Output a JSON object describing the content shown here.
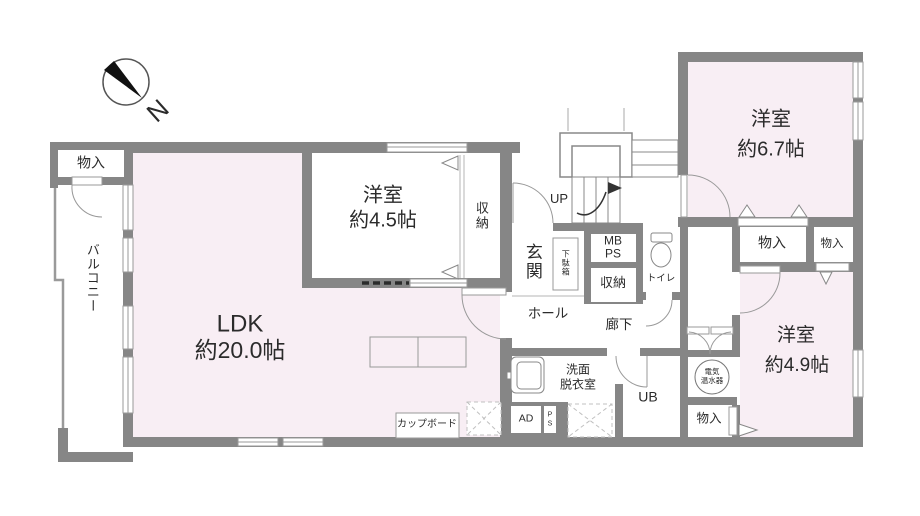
{
  "plan": {
    "compass": {
      "north_label": "N"
    },
    "rooms": {
      "ldk": {
        "name": "LDK",
        "area": "約20.0帖"
      },
      "western_4_5": {
        "name": "洋室",
        "area": "約4.5帖"
      },
      "western_6_7": {
        "name": "洋室",
        "area": "約6.7帖"
      },
      "western_4_9": {
        "name": "洋室",
        "area": "約4.9帖"
      },
      "balcony": {
        "name": "バルコニー"
      },
      "entrance": {
        "name": "玄関"
      },
      "hall": {
        "name": "ホール"
      },
      "corridor": {
        "name": "廊下"
      },
      "toilet": {
        "name": "トイレ"
      },
      "washroom": {
        "line1": "洗面",
        "line2": "脱衣室"
      },
      "unit_bath": {
        "name": "UB"
      }
    },
    "storage": {
      "closet_top_left": "物入",
      "closet_4_5": "収納",
      "shoe_box": "下駄箱",
      "closet_hall": "収納",
      "closet_right_1": "物入",
      "closet_right_2": "物入",
      "closet_bottom_right": "物入",
      "cupboard": "カップボード"
    },
    "utilities": {
      "meter_box_line1": "MB",
      "meter_box_line2": "PS",
      "air_duct": "AD",
      "pipe_space_letter1": "P",
      "pipe_space_letter2": "S",
      "water_heater_line1": "電気",
      "water_heater_line2": "温水器"
    },
    "stairs": {
      "up_label": "UP"
    },
    "colors": {
      "wall": "#868686",
      "room_fill": "#f8eef4",
      "thin_line": "#999999",
      "text": "#2b2b2b"
    }
  }
}
